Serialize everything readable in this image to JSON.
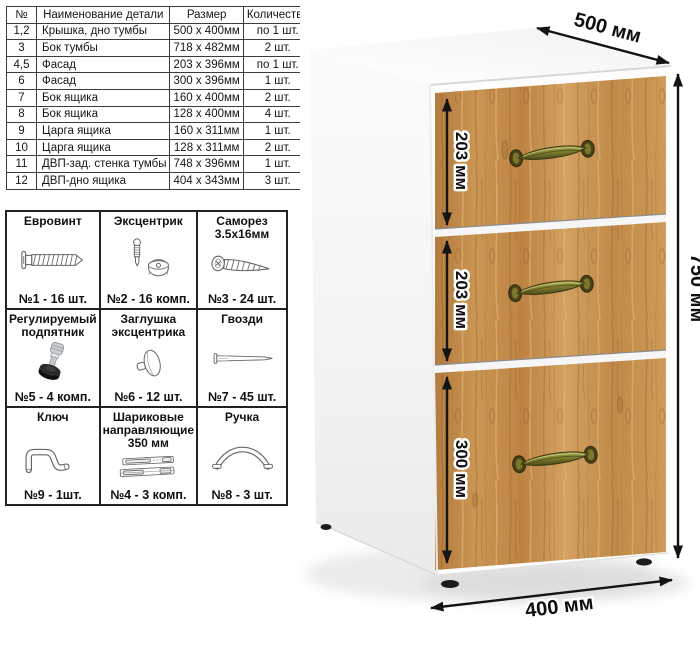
{
  "parts_table": {
    "headers": [
      "№",
      "Наименование детали",
      "Размер",
      "Количество"
    ],
    "rows": [
      [
        "1,2",
        "Крышка, дно тумбы",
        "500 х 400мм",
        "по 1 шт."
      ],
      [
        "3",
        "Бок тумбы",
        "718 х 482мм",
        "2 шт."
      ],
      [
        "4,5",
        "Фасад",
        "203 х 396мм",
        "по 1 шт."
      ],
      [
        "6",
        "Фасад",
        "300 х 396мм",
        "1 шт."
      ],
      [
        "7",
        "Бок ящика",
        "160 х 400мм",
        "2 шт."
      ],
      [
        "8",
        "Бок ящика",
        "128 х 400мм",
        "4 шт."
      ],
      [
        "9",
        "Царга ящика",
        "160 х 311мм",
        "1 шт."
      ],
      [
        "10",
        "Царга ящика",
        "128 х 311мм",
        "2 шт."
      ],
      [
        "11",
        "ДВП-зад. стенка тумбы",
        "748 х 396мм",
        "1 шт."
      ],
      [
        "12",
        "ДВП-дно ящика",
        "404 х 343мм",
        "3 шт."
      ]
    ]
  },
  "hardware": [
    {
      "title": "Евровинт",
      "count": "№1 - 16 шт.",
      "icon": "euro-screw"
    },
    {
      "title": "Эксцентрик",
      "count": "№2 - 16 комп.",
      "icon": "cam-lock"
    },
    {
      "title": "Саморез 3.5х16мм",
      "count": "№3 - 24 шт.",
      "icon": "self-tapping-screw"
    },
    {
      "title": "Регулируемый подпятник",
      "count": "№5 - 4 комп.",
      "icon": "adjustable-foot"
    },
    {
      "title": "Заглушка эксцентрика",
      "count": "№6 - 12 шт.",
      "icon": "cam-cap"
    },
    {
      "title": "Гвозди",
      "count": "№7 - 45 шт.",
      "icon": "nail"
    },
    {
      "title": "Ключ",
      "count": "№9 - 1шт.",
      "icon": "hex-key"
    },
    {
      "title": "Шариковые направляющие 350 мм",
      "count": "№4 - 3 комп.",
      "icon": "drawer-slides"
    },
    {
      "title": "Ручка",
      "count": "№8 - 3 шт.",
      "icon": "handle"
    }
  ],
  "dimensions": {
    "depth": "500 мм",
    "height": "750 мм",
    "width": "400 мм",
    "drawer1": "203 мм",
    "drawer2": "203 мм",
    "drawer3": "300 мм"
  },
  "colors": {
    "wood_base": "#c28a48",
    "wood_dark": "#8f6130",
    "wood_light": "#d9ad74",
    "handle_brass": "#7c7b2d",
    "dimension_text": "#101010"
  }
}
